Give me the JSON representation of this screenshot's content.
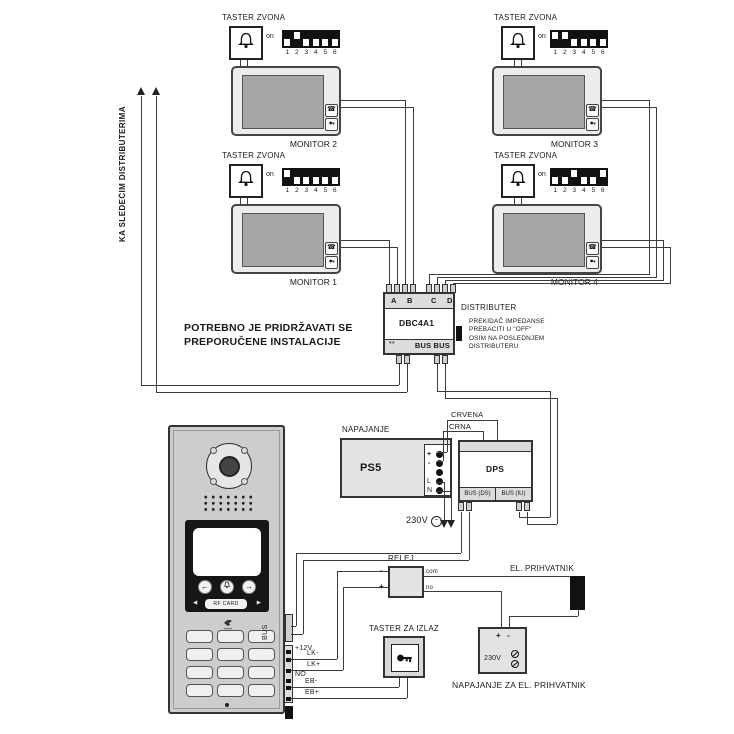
{
  "diagram": {
    "side_note": "KA SLEDEĆIM DISTRIBUTERIMA",
    "warning_line1": "POTREBNO JE PRIDRŽAVATI SE",
    "warning_line2": "PREPORUČENE INSTALACIJE",
    "bell_label": "TASTER ZVONA",
    "dip_on": "on",
    "dip_numbers": [
      "1",
      "2",
      "3",
      "4",
      "5",
      "6"
    ],
    "monitors": [
      {
        "label": "MONITOR 2",
        "dip": [
          0,
          1,
          0,
          0,
          0,
          0
        ]
      },
      {
        "label": "MONITOR 3",
        "dip": [
          1,
          1,
          0,
          0,
          0,
          0
        ]
      },
      {
        "label": "MONITOR 1",
        "dip": [
          1,
          0,
          0,
          0,
          0,
          0
        ]
      },
      {
        "label": "MONITOR 4",
        "dip": [
          0,
          0,
          1,
          0,
          0,
          1
        ]
      }
    ],
    "distributer": {
      "title": "DISTRIBUTER",
      "model": "DBC4A1",
      "terminals": [
        "A",
        "B",
        "C",
        "D"
      ],
      "bus": "BUS BUS",
      "marks": "**",
      "note_line1": "PREKIDAČ IMPEDANSE",
      "note_line2": "PREBACITI U \"OFF\"",
      "note_line3": "OSIM NA POSLEDNJEM",
      "note_line4": "DISTRIBUTERU"
    },
    "psu": {
      "label": "NAPAJANJE",
      "model": "PS5",
      "t_plus": "+",
      "t_minus": "-",
      "t_l": "L",
      "t_n": "N",
      "mains": "230V"
    },
    "wire_red": "CRVENA",
    "wire_black": "CRNA",
    "dps": {
      "model": "DPS",
      "bus_ds": "BUS (DS)",
      "bus_iu": "BUS (IU)"
    },
    "panel": {
      "rf_card": "RF CARD",
      "bus": "BUS",
      "plus12": "+12V",
      "no": "NO",
      "lk_minus": "LK-",
      "lk_plus": "LK+",
      "eb_minus": "EB-",
      "eb_plus": "EB+"
    },
    "relay": {
      "label": "RELEJ",
      "minus": "-",
      "plus": "+",
      "com": "com",
      "no": "no"
    },
    "strike_label": "EL. PRIHVATNIK",
    "exit_button_label": "TASTER ZA IZLAZ",
    "strike_psu": {
      "plus": "+",
      "minus": "-",
      "mains": "230V",
      "label": "NAPAJANJE ZA EL. PRIHVATNIK"
    }
  }
}
